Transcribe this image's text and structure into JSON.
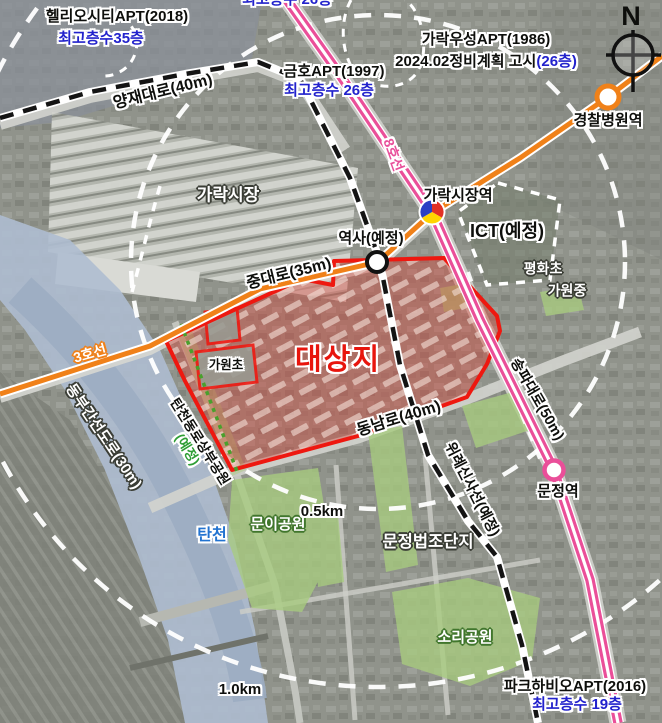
{
  "map": {
    "type": "urban-planning-satellite-map",
    "labels": {
      "top_cutoff_floors": "최고층수 26층",
      "helios_name": "헬리오시티APT(2018)",
      "helios_floors": "최고층수35층",
      "yangjae_road": "양재대로(40m)",
      "kumho_name": "금호APT(1997)",
      "kumho_floors": "최고층수 26층",
      "woosung_name": "가락우성APT(1986)",
      "woosung_notice": "2024.02정비계획 고시",
      "woosung_floors": "(26층)",
      "compass_n": "N",
      "police_hospital_station": "경찰병원역",
      "garak_market": "가락시장",
      "garak_market_station": "가락시장역",
      "ict_planned": "ICT(예정)",
      "pyeonghwa_elementary": "평화초",
      "gawon_middle": "가원중",
      "station_planned": "역사(예정)",
      "jungdae_road": "중대로(35m)",
      "line8": "8호선",
      "line3": "3호선",
      "dongbu_expressway": "동부간선도로(30m)",
      "tancheon_park_main": "탄천동로상부공원",
      "tancheon_park_sub": "(예정)",
      "tancheon_river": "탄천",
      "muni_park": "문이공원",
      "radius_05km": "0.5km",
      "target_site": "대상지",
      "gawon_elementary": "가원초",
      "dongnam_road": "동남로(40m)",
      "wirye_sinsa_line": "위례신사선(예정)",
      "songpa_road": "송파대로(50m)",
      "munjeong_beopjo": "문정법조단지",
      "munjeong_station": "문정역",
      "sori_park": "소리공원",
      "radius_10km": "1.0km",
      "parkhabio_name": "파크하비오APT(2016)",
      "parkhabio_floors": "최고층수 19층"
    },
    "colors": {
      "site_boundary_red": "#ee1810",
      "site_fill_red": "rgba(217,69,58,0.42)",
      "line3_orange": "#f08119",
      "line8_pink": "#ea4f99",
      "floors_text_blue": "#2222cc",
      "planned_text_green": "#2e9e35",
      "river_label_blue": "#2273d0",
      "park_green": "#a8cc7f",
      "river_blue": "#aebdd0",
      "transfer_marker": [
        "#2a3fc4",
        "#e23024",
        "#ffd400"
      ]
    },
    "markers": {
      "garak_market_station_marker": "3-color transfer circle",
      "planned_station_marker": "white circle black ring",
      "police_hospital_station_marker": "white circle orange ring",
      "munjeong_station_marker": "white circle pink ring"
    }
  }
}
